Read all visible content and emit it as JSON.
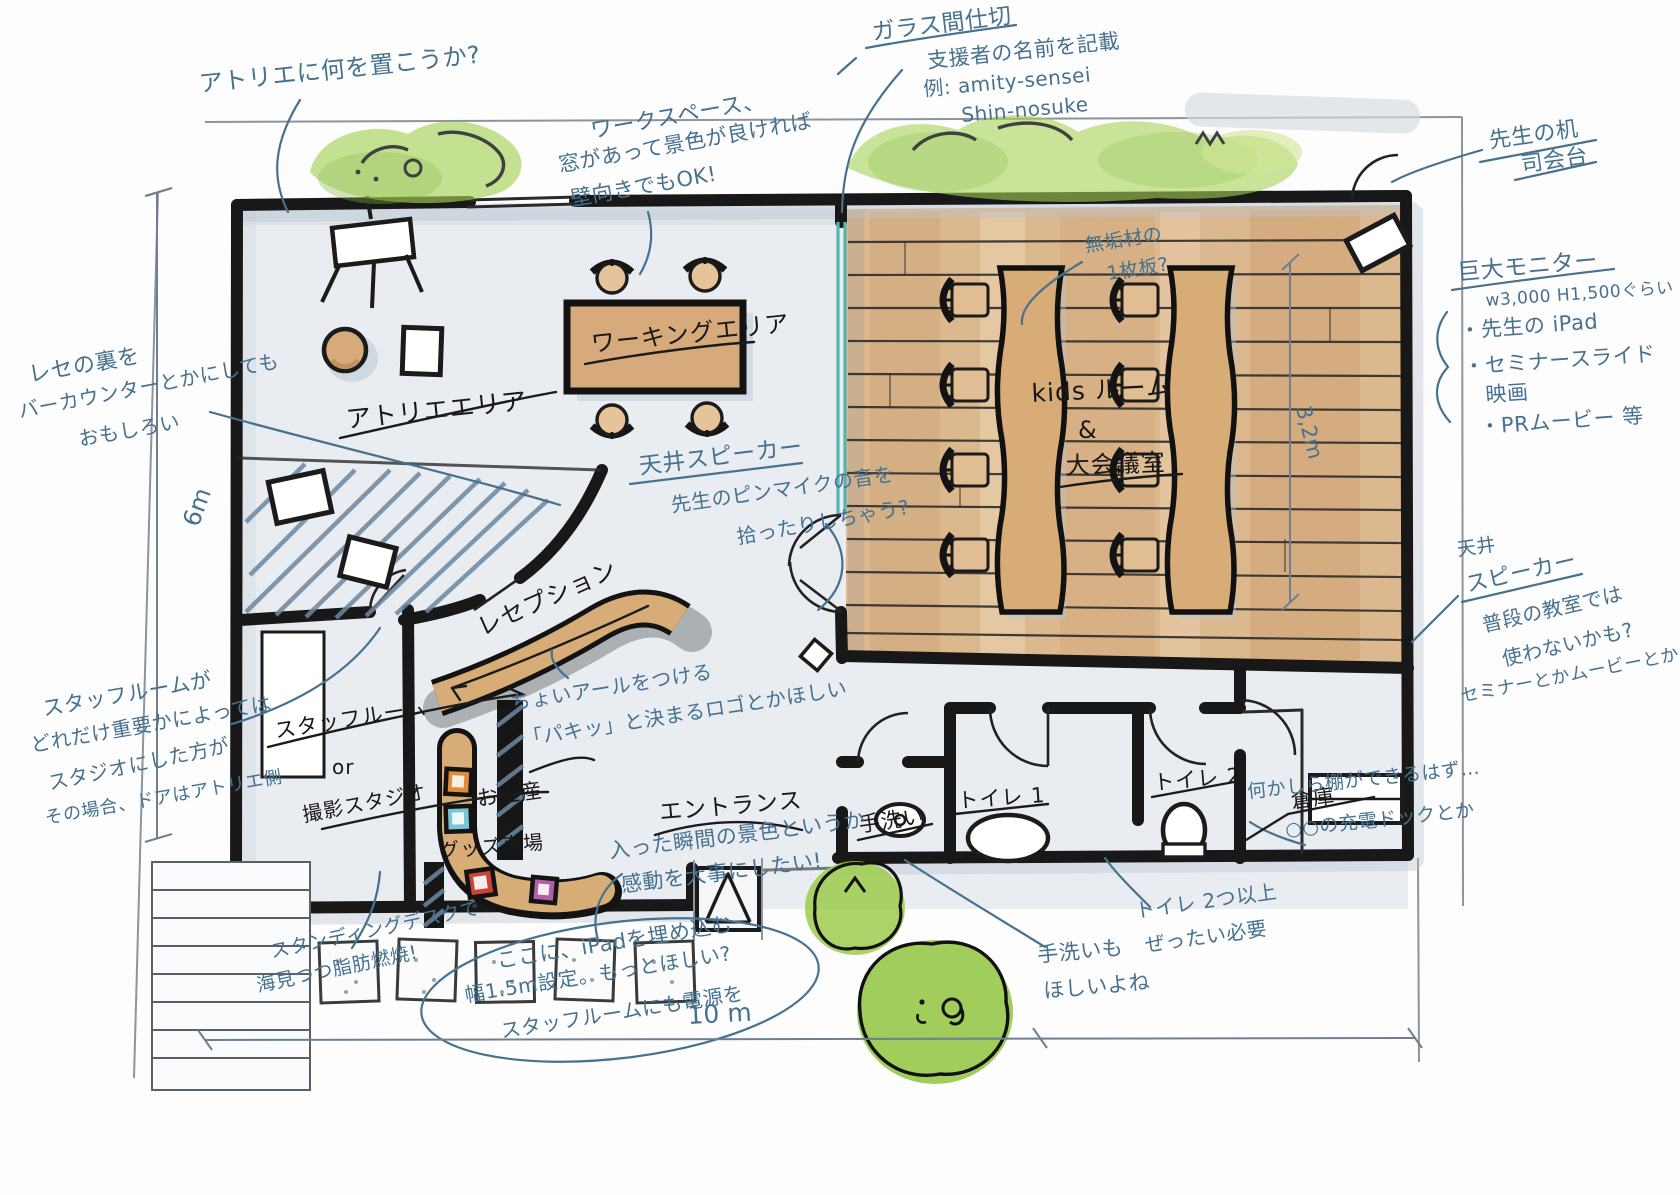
{
  "colors": {
    "ink_blue": "#46718f",
    "ink_black": "#181818",
    "wood": "#d6aa7b",
    "wood_deep": "#c2925f",
    "glass_teal": "#55b6ae",
    "tree_green": "#9ccb4c",
    "floor_gray": "#e9edf2",
    "shadow_blue": "#b8c4d0",
    "swatch_orange": "#df8c3b",
    "swatch_cyan": "#77c5d5",
    "swatch_red": "#c94434",
    "swatch_purple": "#b160a3"
  },
  "rooms": {
    "atelier": "アトリエエリア",
    "working": "ワーキングエリア",
    "kids1": "kids ルーム",
    "kids2": "&",
    "kids3": "大会議室",
    "reception": "レセプション",
    "staff1": "スタッフルーム",
    "staff2": "or",
    "staff3": "撮影スタジオ",
    "shop1": "お土産",
    "shop2": "&",
    "shop3": "グッズ売場",
    "entrance": "エントランス",
    "handwash": "手洗い",
    "toilet1": "トイレ 1",
    "toilet2": "トイレ 2",
    "storage": "倉庫"
  },
  "notes": {
    "atelier_q": {
      "lines": [
        "アトリエに何を置こうか?"
      ]
    },
    "workspace": {
      "lines": [
        "ワークスペース、",
        "窓があって景色が良ければ",
        "壁向きでもOK!"
      ]
    },
    "glass": {
      "lines": [
        "ガラス間仕切",
        "支援者の名前を記載",
        "例: amity-sensei",
        "Shin-nosuke"
      ]
    },
    "teacher": {
      "lines": [
        "先生の机",
        "司会台"
      ]
    },
    "monitor": {
      "lines": [
        "巨大モニター",
        "w3,000 H1,500ぐらい",
        "・先生の iPad",
        "・セミナースライド",
        "映画",
        "・PRムービー 等"
      ]
    },
    "muku": {
      "lines": [
        "無垢材の",
        "1枚板?"
      ]
    },
    "speaker_center": {
      "lines": [
        "天井スピーカー",
        "先生のピンマイクの音を",
        "拾ったりしちゃう?"
      ]
    },
    "bar": {
      "lines": [
        "レセの裏を",
        "バーカウンターとかにしても",
        "おもしろい"
      ]
    },
    "staff_importance": {
      "lines": [
        "スタッフルームが",
        "どれだけ重要かによっては",
        "スタジオにした方が",
        "その場合、ドアはアトリエ側"
      ]
    },
    "arch_logo": {
      "lines": [
        "ちょいアールをつける",
        "「パキッ」と決まるロゴとかほしい"
      ]
    },
    "entrance_feel": {
      "lines": [
        "入った瞬間の景色というか",
        "感動を大事にしたい!"
      ]
    },
    "speaker_right": {
      "lines": [
        "天井",
        "スピーカー",
        "普段の教室では",
        "使わないかも?",
        "セミナーとかムービーとか"
      ]
    },
    "shelf_dock": {
      "lines": [
        "何かしら棚ができるはず…",
        "○○の充電ドックとか"
      ]
    },
    "ipad": {
      "lines": [
        "ここに、iPadを埋め込む",
        "幅1.5m設定。もっとほしい?",
        "スタッフルームにも電源を"
      ]
    },
    "standing_desk": {
      "lines": [
        "スタンディングデスクで",
        "海見つつ脂肪燃焼!"
      ]
    },
    "handwash_want": {
      "lines": [
        "手洗いも",
        "ほしいよね"
      ]
    },
    "toilets_required": {
      "lines": [
        "トイレ 2つ以上",
        "ぜったい必要"
      ]
    }
  },
  "dimensions": {
    "left": "6m",
    "bottom": "10 m",
    "kids_depth": "3,2m"
  }
}
